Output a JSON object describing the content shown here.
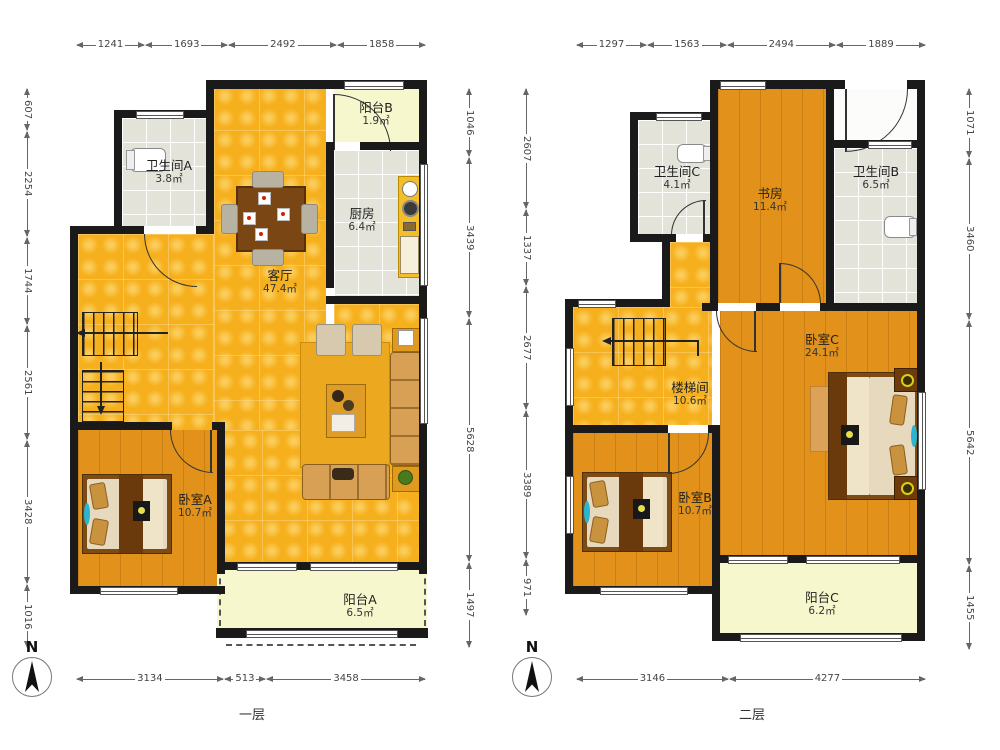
{
  "compass": {
    "label": "N"
  },
  "colors": {
    "wall": "#1a1a1a",
    "living_yellow": "#f6b01d",
    "bedroom_wood": "#e2921b",
    "bath_tile": "#e3e3da",
    "balcony_pale": "#f6f7cd"
  },
  "floor1": {
    "label": "一层",
    "dims": {
      "top": [
        "1241",
        "1693",
        "2492",
        "1858"
      ],
      "left": [
        "607",
        "2254",
        "1744",
        "2561",
        "3428",
        "1016"
      ],
      "right": [
        "1046",
        "3439",
        "5628",
        "1497"
      ],
      "bottom": [
        "3134",
        "513",
        "3458"
      ]
    },
    "rooms": {
      "bathroomA": {
        "name": "卫生间A",
        "area": "3.8㎡"
      },
      "balconyB": {
        "name": "阳台B",
        "area": "1.9㎡"
      },
      "kitchen": {
        "name": "厨房",
        "area": "6.4㎡"
      },
      "living": {
        "name": "客厅",
        "area": "47.4㎡"
      },
      "bedroomA": {
        "name": "卧室A",
        "area": "10.7㎡"
      },
      "balconyA": {
        "name": "阳台A",
        "area": "6.5㎡"
      }
    }
  },
  "floor2": {
    "label": "二层",
    "dims": {
      "top": [
        "1297",
        "1563",
        "2494",
        "1889"
      ],
      "left": [
        "2607",
        "1337",
        "2677",
        "3389",
        "971"
      ],
      "right": [
        "1071",
        "3460",
        "5642",
        "1455"
      ],
      "bottom": [
        "3146",
        "4277"
      ]
    },
    "rooms": {
      "bathroomC": {
        "name": "卫生间C",
        "area": "4.1㎡"
      },
      "study": {
        "name": "书房",
        "area": "11.4㎡"
      },
      "bathroomB": {
        "name": "卫生间B",
        "area": "6.5㎡"
      },
      "stairwell": {
        "name": "楼梯间",
        "area": "10.6㎡"
      },
      "bedroomC": {
        "name": "卧室C",
        "area": "24.1㎡"
      },
      "bedroomB": {
        "name": "卧室B",
        "area": "10.7㎡"
      },
      "balconyC": {
        "name": "阳台C",
        "area": "6.2㎡"
      }
    }
  }
}
